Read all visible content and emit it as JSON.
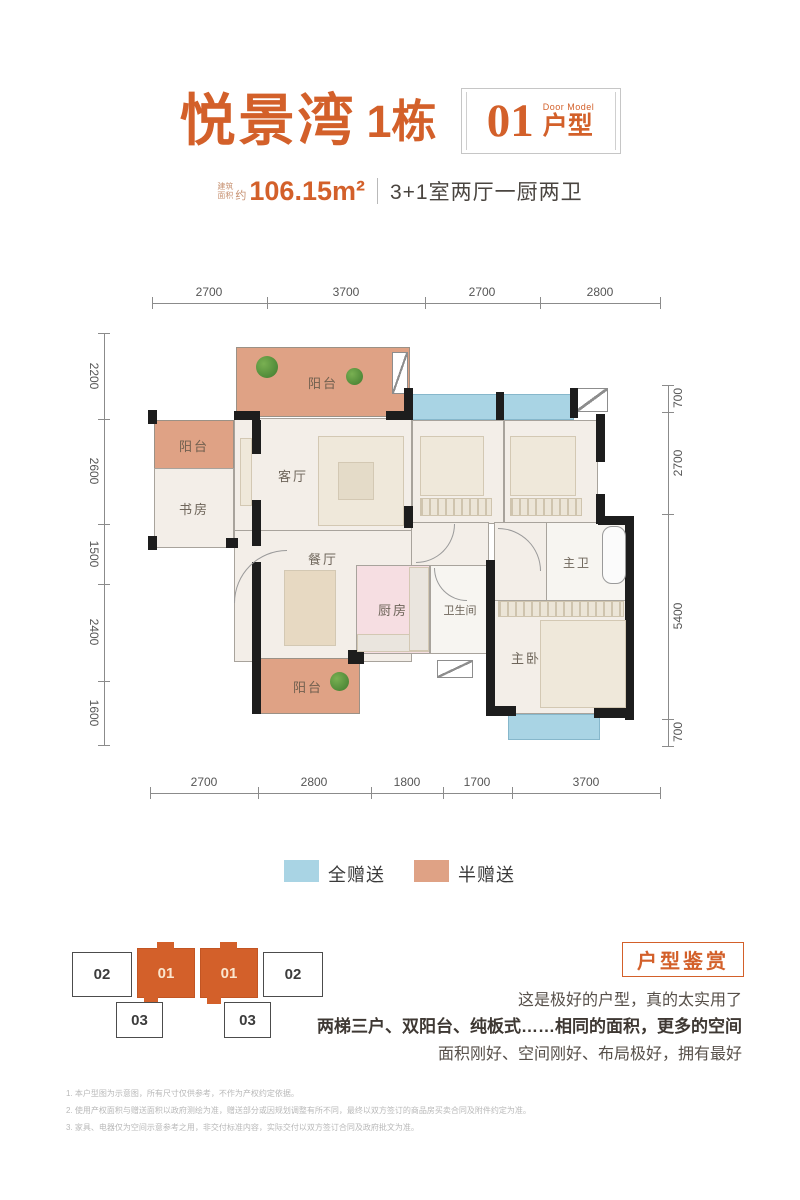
{
  "header": {
    "project_name": "悦景湾",
    "building": "1栋",
    "unit_number": "01",
    "unit_label_en": "Door Model",
    "unit_label_cn": "户型",
    "area_prefix_l1": "建筑",
    "area_prefix_l2": "面积",
    "area_approx": "约",
    "area_value": "106.15m²",
    "layout_desc": "3+1室两厅一厨两卫"
  },
  "floorplan": {
    "dims_top": [
      "2700",
      "3700",
      "2700",
      "2800"
    ],
    "dims_bottom": [
      "2700",
      "2800",
      "1800",
      "1700",
      "3700"
    ],
    "dims_left": [
      "2200",
      "2600",
      "1500",
      "2400",
      "1600"
    ],
    "dims_right": [
      "700",
      "2700",
      "5400",
      "700"
    ],
    "rooms": [
      {
        "id": "balcony-top",
        "label": "阳台"
      },
      {
        "id": "balcony-left",
        "label": "阳台"
      },
      {
        "id": "study",
        "label": "书房"
      },
      {
        "id": "living-room",
        "label": "客厅"
      },
      {
        "id": "bedroom-1",
        "label": "卧室"
      },
      {
        "id": "bedroom-2",
        "label": "卧室"
      },
      {
        "id": "dining-room",
        "label": "餐厅"
      },
      {
        "id": "kitchen",
        "label": "厨房"
      },
      {
        "id": "bathroom",
        "label": "卫生间"
      },
      {
        "id": "master-bath",
        "label": "主卫"
      },
      {
        "id": "master-bedroom",
        "label": "主卧"
      },
      {
        "id": "balcony-bottom",
        "label": "阳台"
      }
    ]
  },
  "legend": {
    "items": [
      {
        "label": "全赠送",
        "color": "#A9D4E4"
      },
      {
        "label": "半赠送",
        "color": "#DFA285"
      }
    ]
  },
  "keyplan": {
    "units": [
      {
        "label": "02",
        "highlighted": false
      },
      {
        "label": "01",
        "highlighted": true
      },
      {
        "label": "01",
        "highlighted": true
      },
      {
        "label": "02",
        "highlighted": false
      },
      {
        "label": "03",
        "highlighted": false
      },
      {
        "label": "03",
        "highlighted": false
      }
    ]
  },
  "review": {
    "title": "户型鉴赏",
    "lines": [
      "这是极好的户型，真的太实用了",
      "两梯三户、双阳台、纯板式……相同的面积，更多的空间",
      "面积刚好、空间刚好、布局极好，拥有最好"
    ]
  },
  "disclaimers": [
    "1. 本户型图为示意图，所有尺寸仅供参考，不作为产权约定依据。",
    "2. 使用产权面积与赠送面积以政府测绘为准，赠送部分或因规划调整有所不同，最终以双方签订的商品房买卖合同及附件约定为准。",
    "3. 家具、电器仅为空间示意参考之用，非交付标准内容，实际交付以双方签订合同及政府批文为准。"
  ],
  "colors": {
    "brand_orange": "#D3602A",
    "full_gift_blue": "#A9D4E4",
    "half_gift_tan": "#DFA285",
    "kitchen_pink": "#F6DEE2",
    "wall_black": "#1D1D1D"
  }
}
